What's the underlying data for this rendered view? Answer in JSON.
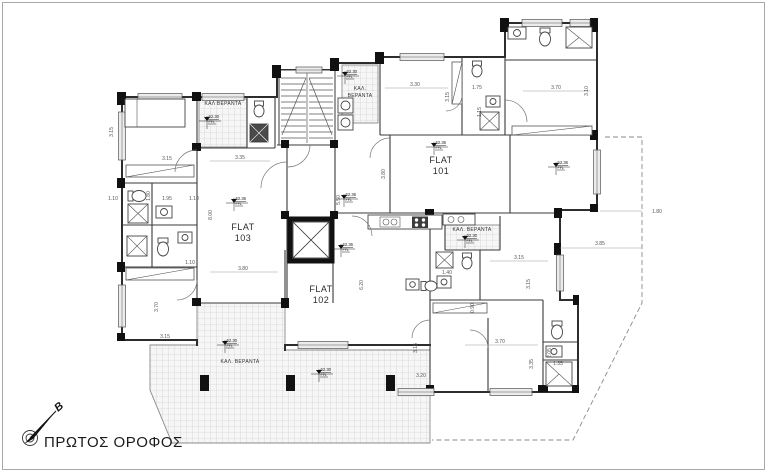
{
  "page": {
    "title": "ΠΡΩΤΟΣ ΟΡΟΦΟΣ",
    "north_label": "B"
  },
  "flats": [
    {
      "name": "FLAT",
      "number": "101"
    },
    {
      "name": "FLAT",
      "number": "102"
    },
    {
      "name": "FLAT",
      "number": "103"
    }
  ],
  "verandas": {
    "top": "ΚΑΛ ΒΕΡΑΝΤΑ",
    "mid_line1": "ΚΑΛ.",
    "mid_line2": "ΒΕΡΑΝΤΑ",
    "right": "ΚΑΛ. ΒΕΡΑΝΤΑ",
    "bottom": "ΚΑΛ. ΒΕΡΑΝΤΑ"
  },
  "levels": {
    "flat_value": "62.36",
    "veranda_value": "62.30",
    "unit": "FFL"
  },
  "dimensions": [
    {
      "v": "3.30"
    },
    {
      "v": "3.15"
    },
    {
      "v": "1.75"
    },
    {
      "v": "1.15"
    },
    {
      "v": "3.70"
    },
    {
      "v": "3.10"
    },
    {
      "v": "3.15"
    },
    {
      "v": "3.15"
    },
    {
      "v": "3.35"
    },
    {
      "v": "8.00"
    },
    {
      "v": "3.80"
    },
    {
      "v": "1.80"
    },
    {
      "v": "1.95"
    },
    {
      "v": "1.10"
    },
    {
      "v": "1.10"
    },
    {
      "v": "1.10"
    },
    {
      "v": "3.70"
    },
    {
      "v": "3.15"
    },
    {
      "v": "5.50"
    },
    {
      "v": "6.20"
    },
    {
      "v": "3.80"
    },
    {
      "v": "3.15"
    },
    {
      "v": "3.15"
    },
    {
      "v": "0.90"
    },
    {
      "v": "1.40"
    },
    {
      "v": "3.70"
    },
    {
      "v": "3.35"
    },
    {
      "v": "3.15"
    },
    {
      "v": "3.20"
    },
    {
      "v": "2.05"
    },
    {
      "v": "1.35"
    },
    {
      "v": "3.85"
    },
    {
      "v": "1.80"
    }
  ],
  "colors": {
    "wall": "#2d2d2d",
    "dim_text": "#555555",
    "tile_line": "#c9c9c9",
    "column": "#111111"
  }
}
